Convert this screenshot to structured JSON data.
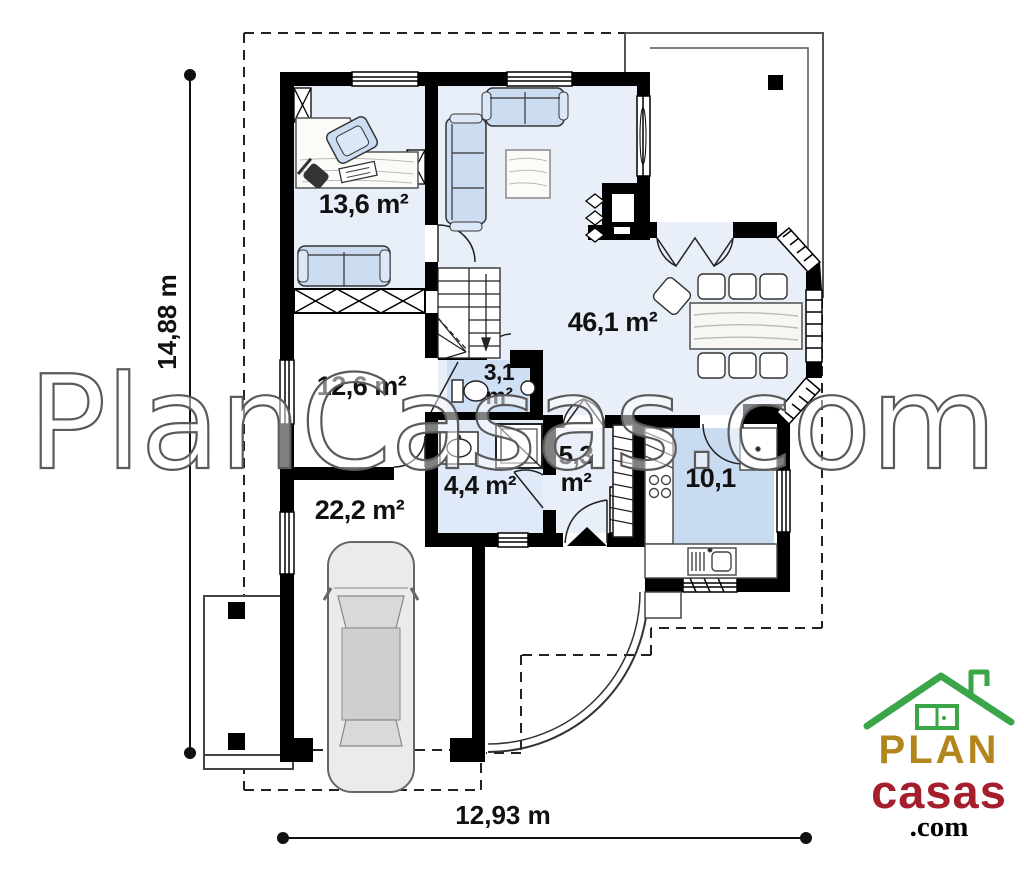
{
  "watermark": "PlanCasas.com",
  "dimensions": {
    "vertical_label": "14,88 m",
    "horizontal_label": "12,93 m"
  },
  "rooms": {
    "office_area": "13,6 m²",
    "living_area": "46,1 m²",
    "storage_area": "12,6 m²",
    "garage_area": "22,2 m²",
    "wc_area_line1": "3,1",
    "wc_area_line2": "m²",
    "bathroom_area": "4,4 m²",
    "hall_area_line1": "5,3",
    "hall_area_line2": "m²",
    "kitchen_area": "10,1"
  },
  "logo": {
    "word_plan": "PLAN",
    "word_casas": "casas",
    "word_com": ".com",
    "colors": {
      "roof": "#3aa648",
      "plan": "#b2861c",
      "casas": "#a51e2d",
      "com": "#000000"
    }
  },
  "colors": {
    "wall": "#000000",
    "floor_light_blue": "#e9eff9",
    "floor_kitchen_blue": "#c9dbf0",
    "floor_wc_blue": "#cfe0f4",
    "furniture_blue": "#ccddf2",
    "watermark_stroke": "#5a5a5a"
  }
}
